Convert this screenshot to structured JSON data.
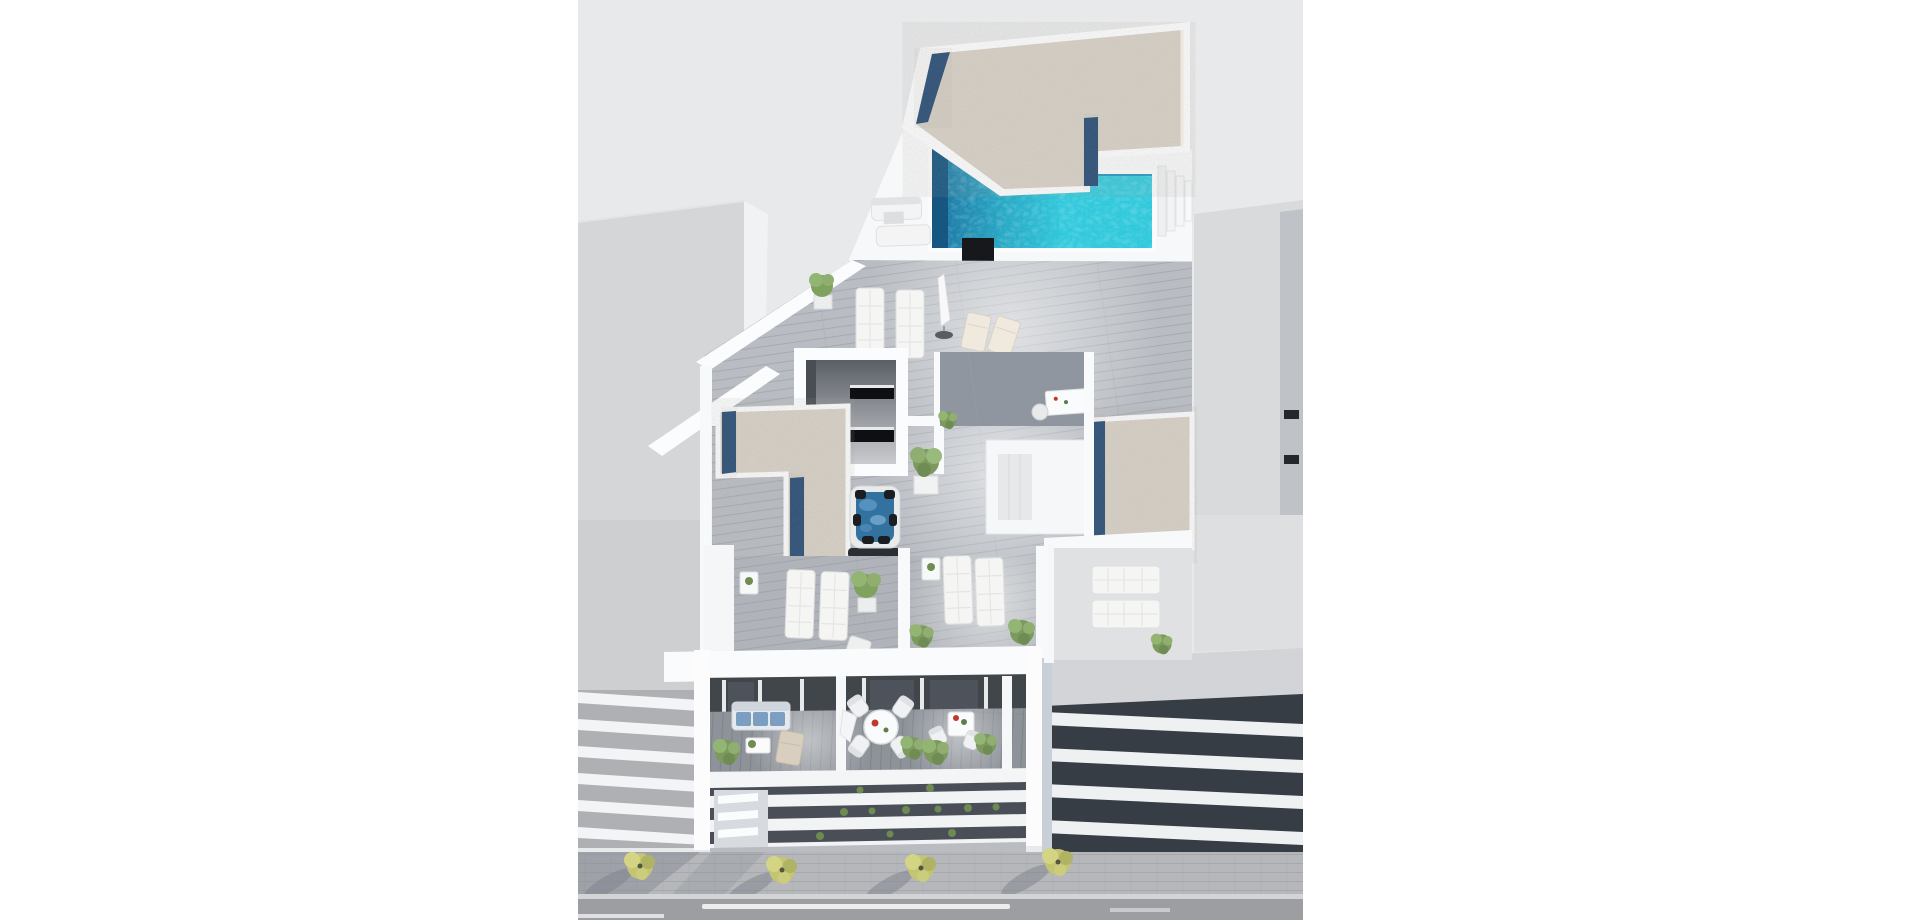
{
  "scene": {
    "title": "3D aerial render - residential building with rooftop pool and solarium",
    "type": "3d-architectural-render",
    "view": "aerial axonometric cut-away",
    "page_background": "#ffffff",
    "render_background": "#e8e9eb"
  },
  "palette": {
    "page_bg": "#ffffff",
    "render_bg": "#e8e9eb",
    "building_white": "#f8f9fa",
    "neighbor_gray": "#d5d6d8",
    "gravel_beige": "#d7d1c7",
    "gravel_blue": "#2e5178",
    "pool_deep": "#1a6f9e",
    "pool_bright": "#2ec8dc",
    "pool_edge": "#15537d",
    "hot_tub_water": "#33719f",
    "wood_deck": "#b9bdc3",
    "wood_balcony": "#8e939a",
    "interior_dark": "#41464b",
    "facade_dark": "#4a4f57",
    "sofa_blue": "#7c9ec0",
    "accent_red": "#c0392b",
    "tree_green": "#c3c572",
    "plant_green": "#7c9a5e",
    "street_gray": "#b5b7ba",
    "road_gray": "#9c9ea1",
    "marking_white": "#eceded",
    "chimney_black": "#16181c"
  },
  "elements": [
    {
      "name": "left-neighbor-building",
      "label": "Neighbouring building (left) with striped balcony slabs"
    },
    {
      "name": "right-neighbor-building",
      "label": "Neighbouring building (right) with dark window bands"
    },
    {
      "name": "gravel-roof",
      "label": "Rooftop gravel roof with dark blue border strips"
    },
    {
      "name": "swimming-pool",
      "label": "Rooftop swimming pool, turquoise water with deep blue end"
    },
    {
      "name": "pool-stairs",
      "label": "White steps beside the pool"
    },
    {
      "name": "chimney",
      "label": "Black chimney / ventilation column"
    },
    {
      "name": "pool-deck",
      "label": "Pool deck with outdoor sofas, sun loungers, parasol and deck chairs"
    },
    {
      "name": "skylight-room",
      "label": "Cut-away stairwell with dark window slits"
    },
    {
      "name": "lower-gravel-roof",
      "label": "Lower L-shaped gravel roof section with blue strips"
    },
    {
      "name": "hot-tub",
      "label": "Square hot tub (jacuzzi) with black seat pads"
    },
    {
      "name": "solarium-terraces",
      "label": "Solarium terraces with white sun loungers, side tables and potted plants"
    },
    {
      "name": "balcony-level",
      "label": "Balcony level: blue sofa set, round dining table with red accent, bistro table, planters"
    },
    {
      "name": "street-facade",
      "label": "Street facade with white slab bands, planter greenery and louver vents"
    },
    {
      "name": "sidewalk",
      "label": "Paved sidewalk with four green street trees and long shadows"
    },
    {
      "name": "road",
      "label": "Asphalt road with white lane markings"
    }
  ],
  "object_counts": {
    "street_trees": 4,
    "balconies": 3,
    "sun_lounger_groups": 3,
    "gravel_roof_sections": 3
  }
}
